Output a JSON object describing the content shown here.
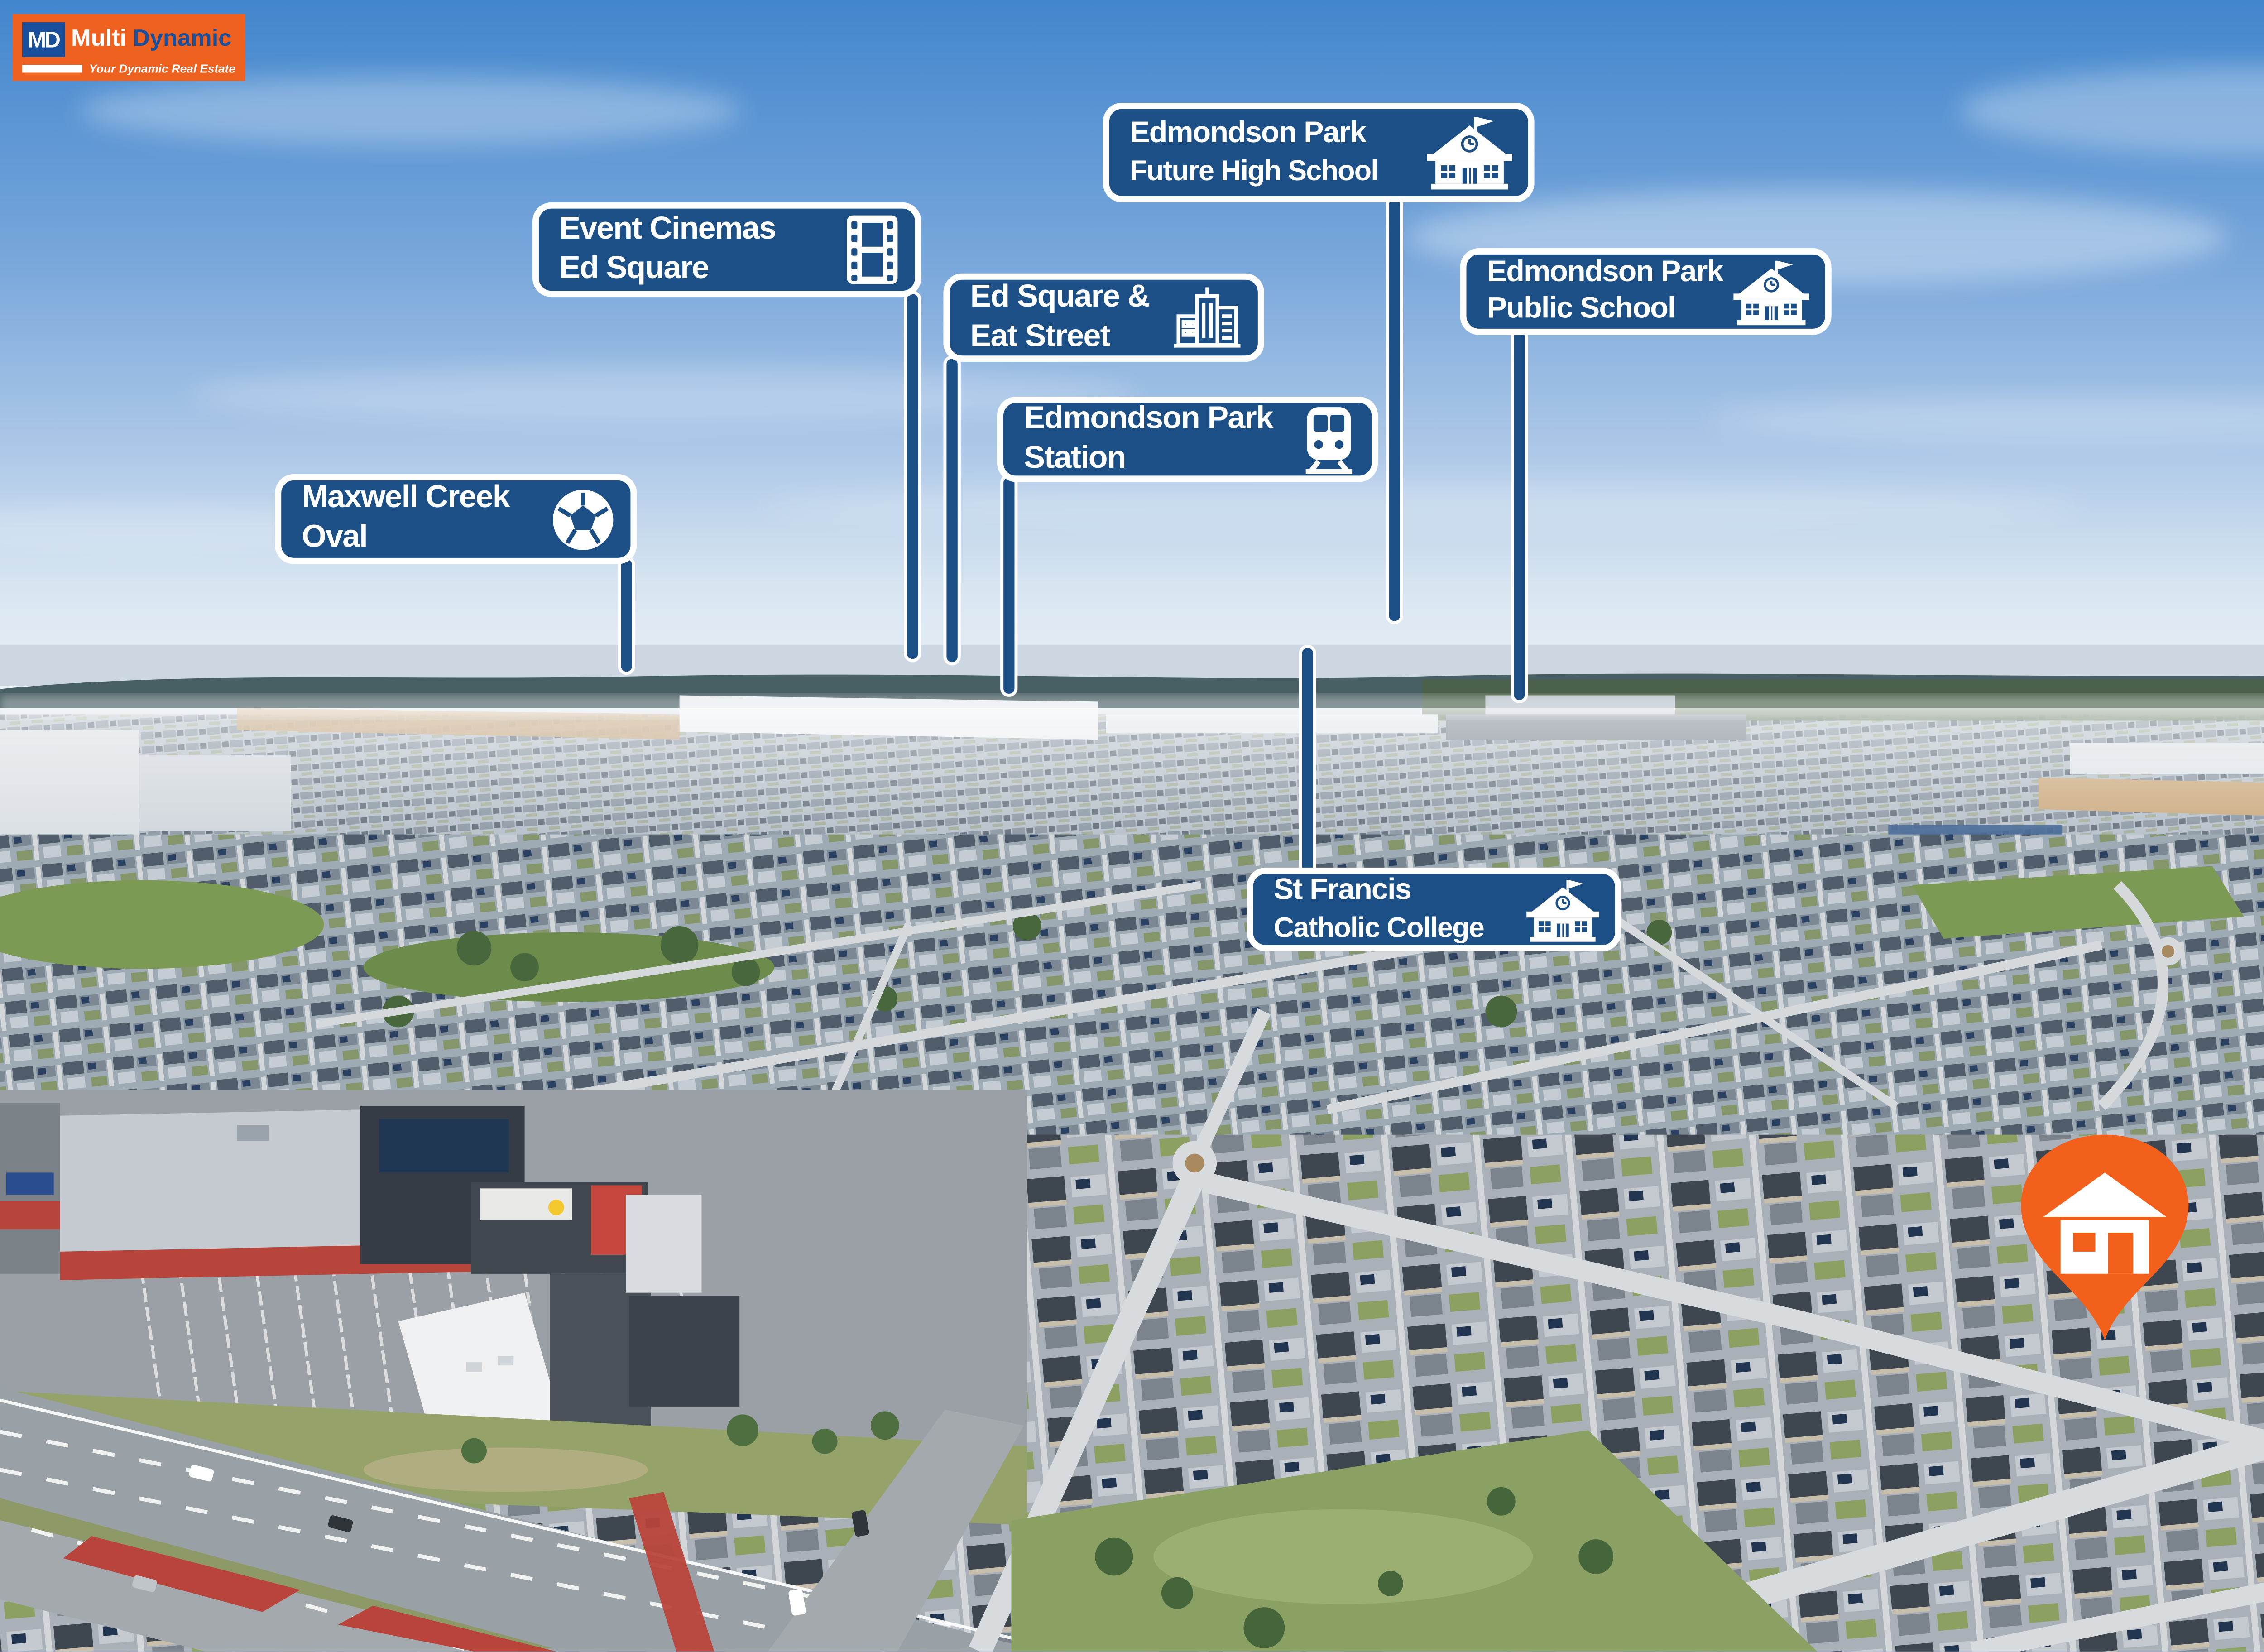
{
  "brand": {
    "md": "MD",
    "name1": "Multi",
    "name2": "Dynamic",
    "tagline": "Your Dynamic Real Estate"
  },
  "labels": [
    {
      "id": "maxwell-creek-oval",
      "line1": "Maxwell Creek",
      "line2": "Oval",
      "icon": "soccer-ball-icon"
    },
    {
      "id": "event-cinemas-ed-square",
      "line1": "Event Cinemas",
      "line2": "Ed Square",
      "icon": "cinema-icon"
    },
    {
      "id": "ed-square-eat-street",
      "line1": "Ed Square &",
      "line2": "Eat Street",
      "icon": "city-buildings-icon"
    },
    {
      "id": "edmondson-park-station",
      "line1": "Edmondson Park",
      "line2": "Station",
      "icon": "train-icon"
    },
    {
      "id": "edmondson-park-future-high-school",
      "line1": "Edmondson Park",
      "line2": "Future High School",
      "icon": "school-icon"
    },
    {
      "id": "edmondson-park-public-school",
      "line1": "Edmondson Park",
      "line2": "Public School",
      "icon": "school-icon"
    },
    {
      "id": "st-francis-catholic-college",
      "line1": "St Francis",
      "line2": "Catholic College",
      "icon": "school-icon"
    }
  ],
  "marker": {
    "name": "property-location",
    "icon": "house-icon"
  },
  "colors": {
    "sign_blue": "#1d4f87",
    "pin_orange": "#f2601c",
    "logo_orange": "#ee611e",
    "logo_blue": "#1a4f9c",
    "sign_text": "#ffffff"
  }
}
